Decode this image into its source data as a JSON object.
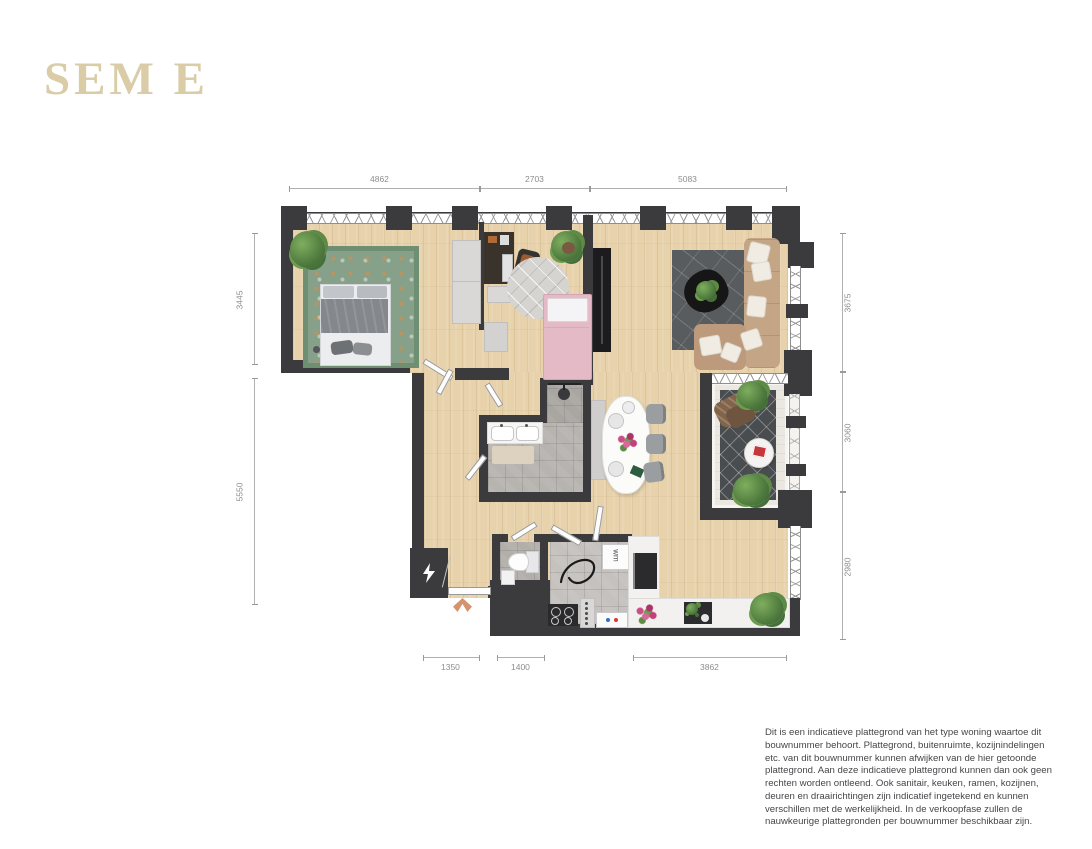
{
  "title": "SEM E",
  "plan": {
    "dimensions": {
      "top": [
        "4862",
        "2703",
        "5083"
      ],
      "left": [
        "3445",
        "5550"
      ],
      "right": [
        "3675",
        "3060",
        "2980"
      ],
      "bottom": [
        "1350",
        "1400",
        "3862"
      ]
    },
    "labels": {
      "washing_machine": "wm"
    },
    "colors": {
      "logo": "#d9cca6",
      "wall": "#3b3b3d",
      "floor_wood": "#e7d2ab",
      "floor_tile": "#b7b3af",
      "balcony_floor": "#eae8e1",
      "accent_arrow": "#d5936f"
    }
  },
  "disclaimer": "Dit is een indicatieve plattegrond van het type woning waartoe dit bouwnummer behoort. Plattegrond, buitenruimte, kozijnindelingen etc. van dit bouwnummer kunnen afwijken van de hier getoonde plattegrond. Aan deze indicatieve plattegrond kunnen dan ook geen rechten worden ontleend. Ook sanitair, keuken, ramen, kozijnen, deuren en draairichtingen zijn indicatief ingetekend en kunnen verschillen met de werkelijkheid. In de verkoopfase zullen de nauwkeurige plattegronden per bouwnummer beschikbaar zijn."
}
